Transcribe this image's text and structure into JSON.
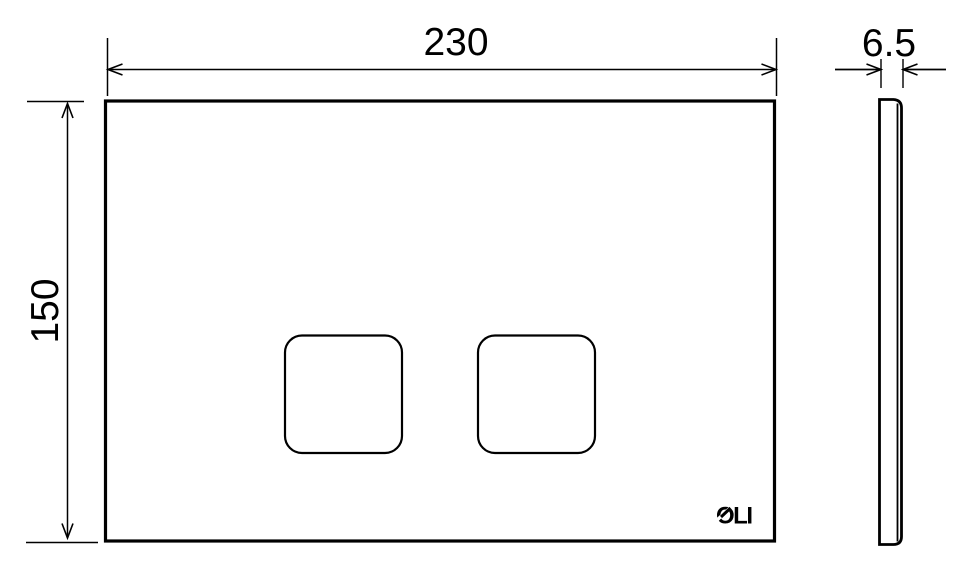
{
  "drawing": {
    "background_color": "#ffffff",
    "line_color": "#000000",
    "dimensions": {
      "width": "230",
      "height": "150",
      "thickness": "6.5"
    },
    "logo_text": "OLI"
  }
}
